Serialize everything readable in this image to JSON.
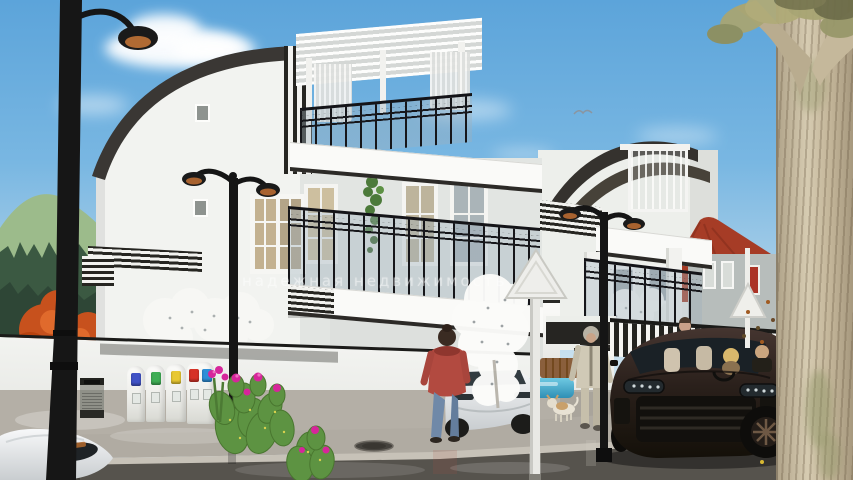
{
  "scene": {
    "type": "architectural-exterior-3d-render",
    "watermark": "надежная недвижимость"
  },
  "palette": {
    "sky-top": "#5ca4da",
    "sky-horizon": "#cfe4f0",
    "cloud": "#ffffff",
    "wall-white": "#f2f2ef",
    "trim-dark": "#262521",
    "glass": "#9fb3c0",
    "red-roof": "#a63c26",
    "autumn": "#c7511d",
    "hill": "#9cbb8b",
    "pine": "#3b5942",
    "sidewalk": "#b0aba2",
    "asphalt": "#56534d",
    "pool": "#3b9fc4",
    "suv-body": "#2a201b",
    "car-white": "#eceeef",
    "cactus": "#5d9342",
    "flower-pink": "#d6269b",
    "lamp-black": "#161616",
    "trunk-bark": "#c5b99e"
  },
  "bins": {
    "units": [
      {
        "flaps": [
          "#4053c6"
        ]
      },
      {
        "flaps": [
          "#3fae55"
        ]
      },
      {
        "flaps": [
          "#e8c832"
        ]
      },
      {
        "flaps": [
          "#d63226",
          "#2f8fd8"
        ]
      }
    ]
  }
}
